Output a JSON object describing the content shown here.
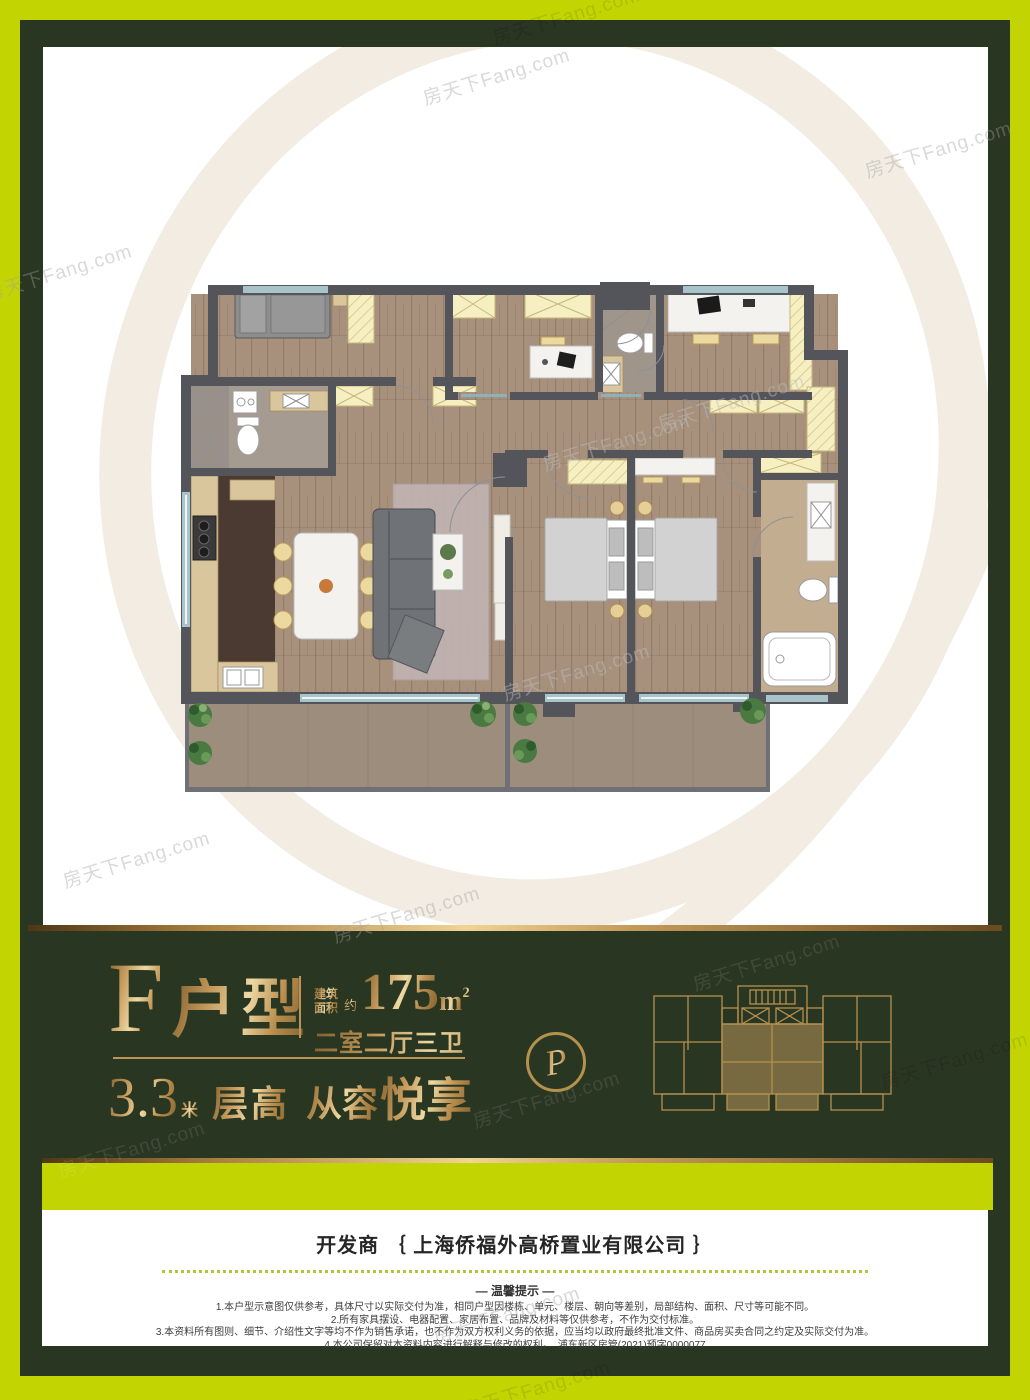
{
  "watermark": "房天下Fang.com",
  "colors": {
    "lime": "#c2d503",
    "dark_green": "#293621",
    "gold": "#c59a5c",
    "gold_light": "#eed9a4"
  },
  "unit_info": {
    "unit_letter": "F",
    "unit_label": "户型",
    "area_prefix_line1": "建筑",
    "area_prefix_line2": "面积",
    "area_approx": "约",
    "area_value": "175",
    "area_unit": "m",
    "area_unit_sup": "2",
    "layout_text": "二室二厅三卫",
    "height_value": "3.3",
    "height_unit": "米",
    "height_label": "层高",
    "slogan_light": "从容",
    "slogan_strong": "悦享",
    "emblem_letter": "P"
  },
  "footer": {
    "developer_line": "开发商 ｛ 上海侨福外高桥置业有限公司 ｝",
    "tips_title": "— 温馨提示 —",
    "tips": [
      "1.本户型示意图仅供参考，具体尺寸以实际交付为准，相同户型因楼栋、单元、楼层、朝向等差别，局部结构、面积、尺寸等可能不同。",
      "2.所有家具摆设、电器配置、家居布置、品牌及材料等仅供参考，不作为交付标准。",
      "3.本资料所有图则、细节、介绍性文字等均不作为销售承诺，也不作为双方权利义务的依据，应当均以政府最终批准文件、商品房买卖合同之约定及实际交付为准。",
      "4.本公司保留对本资料内容进行解释与修改的权利。　浦东新区房管(2021)预字0000077"
    ]
  }
}
